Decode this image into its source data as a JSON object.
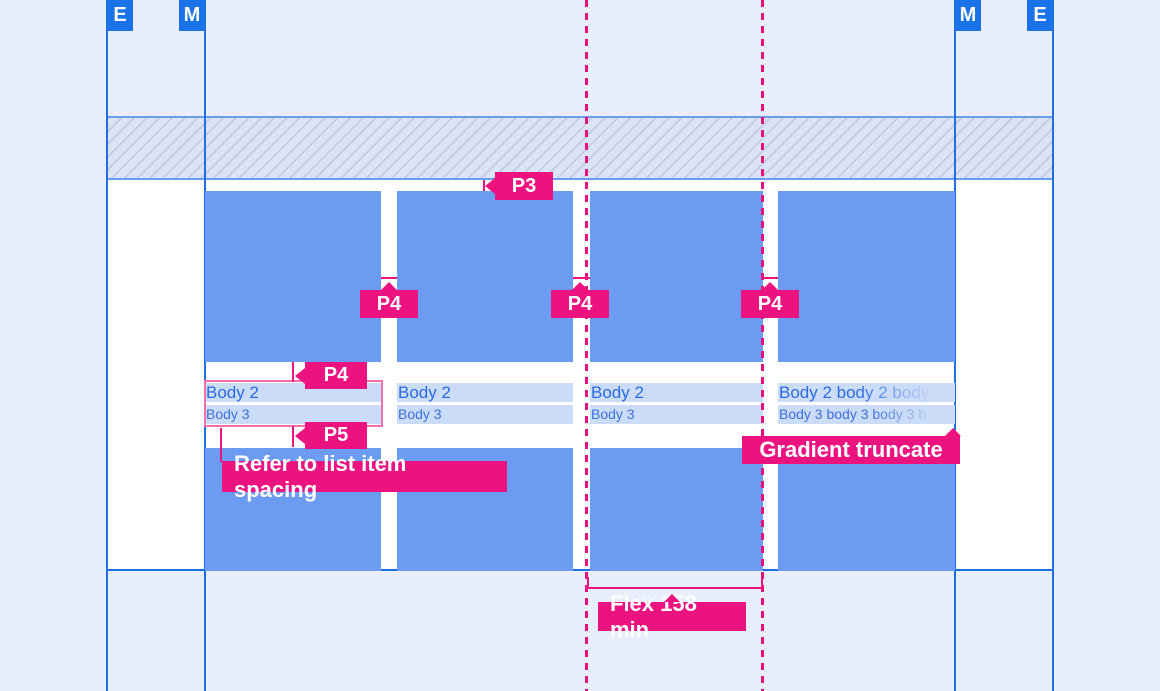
{
  "page": {
    "background": "#e8eefb",
    "content_background": "#ffffff",
    "description_colors": {
      "accent_pink": "#ec1380",
      "guide_blue": "#1a73e8",
      "guideline_blue": "#1f6fe3",
      "tile_blue": "#6c9cf1",
      "text_highlight_band": "#cbdcf8",
      "body2_text_blue": "#2d6ae2",
      "body3_text_blue": "#3c71dd",
      "text_block_outline_pink": "#f56fab",
      "hatch_stripe": "#c3cee3",
      "hatch_background": "#dbe4f5"
    }
  },
  "guide_labels": {
    "left_edge": "E",
    "left_margin": "M",
    "right_margin": "M",
    "right_edge": "E"
  },
  "cards": [
    {
      "line1": "Body 2",
      "line2": "Body 3"
    },
    {
      "line1": "Body 2",
      "line2": "Body 3"
    },
    {
      "line1": "Body 2",
      "line2": "Body 3"
    },
    {
      "line1": "Body 2 body 2 body",
      "line2": "Body 3 body 3 body 3 b"
    }
  ],
  "annotations": {
    "top_padding": "P3",
    "gutter_1": "P4",
    "gutter_2": "P4",
    "gutter_3": "P4",
    "image_text_spacing": "P4",
    "text_bottom_spacing": "P5",
    "refer_note": "Refer to list item spacing",
    "gradient_note": "Gradient truncate",
    "flex_note": "Flex 158 min"
  }
}
